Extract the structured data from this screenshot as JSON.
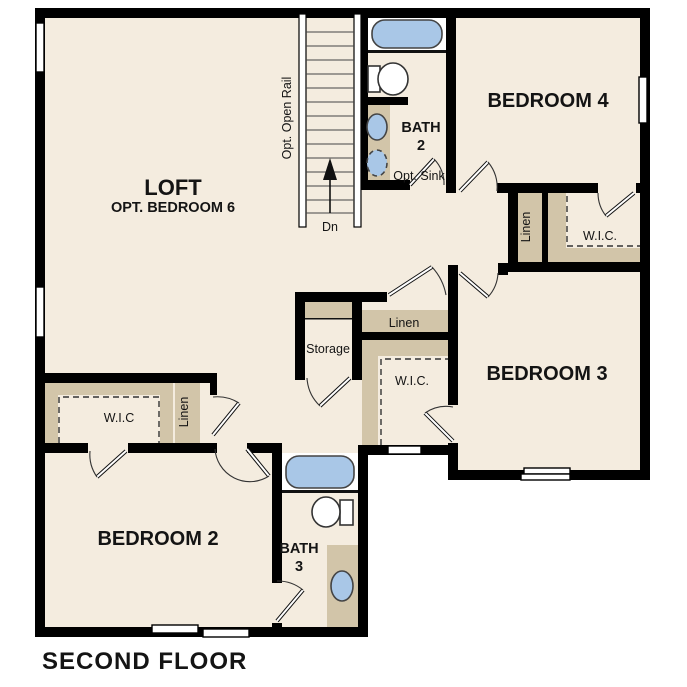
{
  "title": "SECOND FLOOR",
  "colors": {
    "floor": "#f4ecdf",
    "wall": "#000000",
    "cabinet": "#d2c5a9",
    "fixture_blue": "#a9c7e7",
    "fixture_outline": "#444444",
    "window": "#ffffff",
    "text": "#141414"
  },
  "rooms": {
    "loft": {
      "name": "LOFT",
      "subtitle": "OPT. BEDROOM 6"
    },
    "bedroom4": {
      "name": "BEDROOM 4"
    },
    "bedroom3": {
      "name": "BEDROOM 3"
    },
    "bedroom2": {
      "name": "BEDROOM 2"
    },
    "bath2": {
      "name": "BATH",
      "number": "2",
      "note": "Opt. Sink"
    },
    "bath3": {
      "name": "BATH",
      "number": "3"
    }
  },
  "closets": {
    "wic_bedroom4": "W.I.C.",
    "wic_bedroom3": "W.I.C.",
    "wic_bedroom2": "W.I.C",
    "linen_bedroom4": "Linen",
    "linen_hall": "Linen",
    "linen_bedroom2": "Linen",
    "storage": "Storage"
  },
  "stairs": {
    "down_label": "Dn",
    "rail_label": "Opt. Open Rail"
  }
}
